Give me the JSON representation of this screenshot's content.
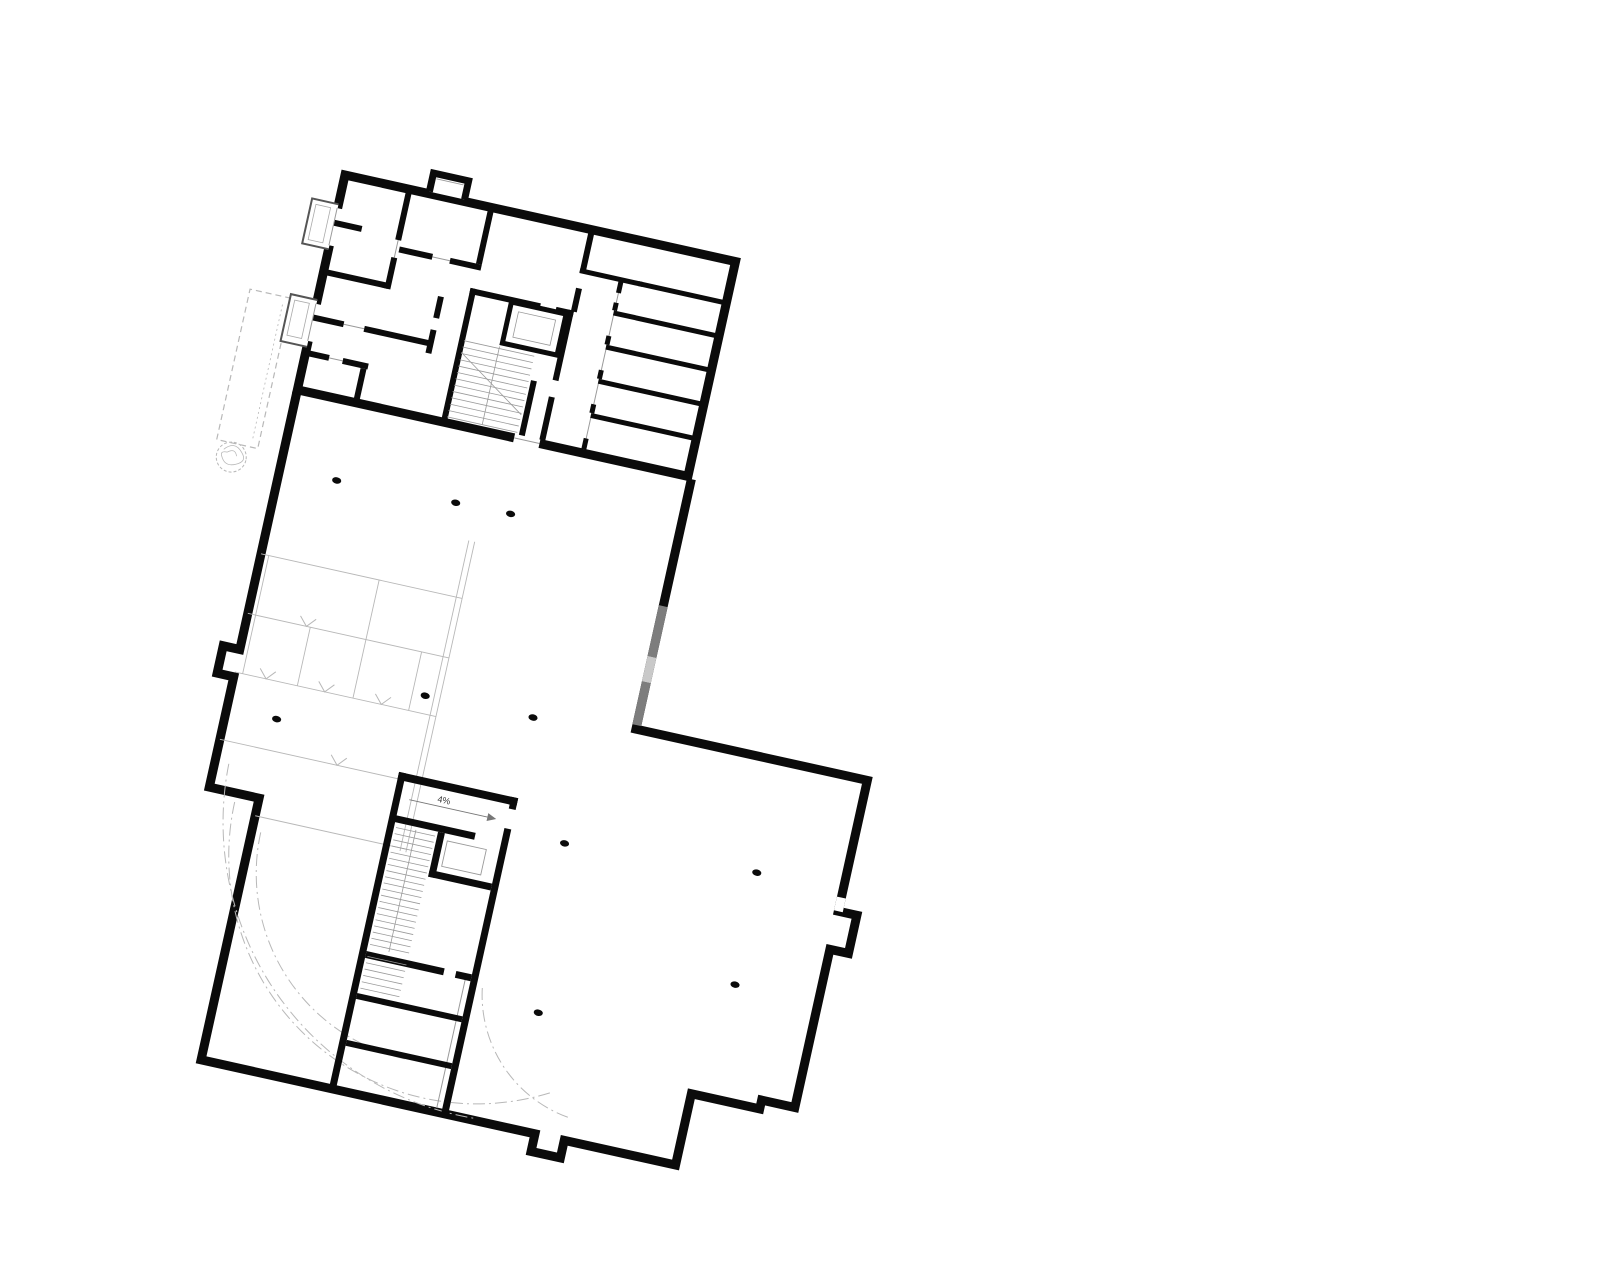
{
  "document": {
    "type": "architectural floor plan",
    "level": "basement / underground parking storey",
    "style": "poché black walls on white"
  },
  "labels": {
    "ramp_slope": "4%"
  },
  "palette": {
    "wall": "#0b0b0b",
    "thin": "#9a9a9a",
    "light": "#b8b8b8",
    "gray_dark": "#7d7d7d",
    "gray_light": "#c9c9c9",
    "bg": "#ffffff"
  },
  "canvas": {
    "width": 1600,
    "height": 1268
  },
  "transform": {
    "rotation_deg": 12.5,
    "pivot_x": 345,
    "pivot_y": 175
  },
  "plan": {
    "elements": [
      {
        "el": "path",
        "name": "canopy-outline",
        "stroke": "light",
        "sw": 1.2,
        "dash": "6 4",
        "fill": "none",
        "d": "M -26,132 L -68,132 L -68,286 L -26,286 Z"
      },
      {
        "el": "path",
        "name": "canopy-center-line",
        "stroke": "light",
        "sw": 0.8,
        "dash": "2 3",
        "fill": "none",
        "d": "M -33,140 L -33,280"
      },
      {
        "el": "circle",
        "name": "tree-symbol",
        "cx": -50,
        "cy": 300,
        "r": 15,
        "stroke": "light",
        "sw": 1,
        "dash": "3 2",
        "fill": "none"
      },
      {
        "el": "path",
        "name": "tree-crown-scribble",
        "stroke": "light",
        "sw": 0.8,
        "fill": "none",
        "d": "M -59,294 Q -50,283 -41,293 Q -33,301 -44,306 Q -54,311 -59,302 Q -63,296 -55,296 Q -48,290 -45,298"
      },
      {
        "el": "path",
        "name": "garage-outline",
        "fill": "#ffffff",
        "stroke": "wall",
        "sw": 9,
        "d": "M 0,222 L 0,486 L -17,486 L -17,514 L 0,514 L 0,627 L 51,627 L 51,895 L 393,895 L 393,913 L 423,913 L 423,895 L 537,895 L 537,822 L 607,822 L 607,813 L 641,813 L 641,651 L 660,651 L 660,612 L 641,612 L 641,478 L 404,478 L 404,222"
      },
      {
        "el": "rects",
        "name": "retaining-wall-gray",
        "fill": "gray_dark",
        "items": [
          [
            399.5,
            352,
            9,
            52
          ],
          [
            399.5,
            430,
            9,
            44
          ]
        ]
      },
      {
        "el": "rects",
        "name": "retaining-wall-lightgray",
        "fill": "gray_light",
        "items": [
          [
            399.5,
            404,
            9,
            26
          ]
        ]
      },
      {
        "el": "rects",
        "name": "garage-door-gap",
        "fill": "#ffffff",
        "items": [
          [
            636.5,
            598,
            9,
            14
          ]
        ]
      },
      {
        "el": "lines2",
        "name": "parking-stall-lines",
        "stroke": "light",
        "sw": 0.9,
        "items": [
          [
            0,
            388,
            206,
            388
          ],
          [
            0,
            449,
            206,
            449
          ],
          [
            0,
            509,
            206,
            509
          ],
          [
            0,
            578,
            206,
            578
          ],
          [
            51,
            645,
            206,
            645
          ],
          [
            8,
            388,
            8,
            509
          ],
          [
            64,
            449,
            64,
            509
          ],
          [
            121,
            388,
            121,
            509
          ],
          [
            178,
            449,
            178,
            509
          ],
          [
            200,
            330,
            200,
            648
          ],
          [
            206,
            330,
            206,
            648
          ]
        ]
      },
      {
        "el": "chevrons",
        "name": "parking-direction-chevron",
        "stroke": "light",
        "sw": 1,
        "points": [
          [
            32,
            509
          ],
          [
            92,
            509
          ],
          [
            150,
            509
          ],
          [
            120,
            578
          ],
          [
            60,
            449
          ]
        ]
      },
      {
        "el": "paths",
        "name": "ramp-dashdot-arc",
        "stroke": "light",
        "sw": 1,
        "dash": "12 4 2 4",
        "fill": "none",
        "items": [
          "M 28,636 A 248 248 0 0 0 400,851",
          "M 14,600 A 300 300 0 0 0 330,893",
          "M 60,660 A 190 190 0 0 0 250,850",
          "M 310,764 A 130 130 0 0 0 424,872"
        ]
      },
      {
        "el": "columns",
        "name": "column",
        "fill": "wall",
        "rx": 4.6,
        "ry": 3.2,
        "points": [
          [
            58,
            300
          ],
          [
            179,
            296
          ],
          [
            235,
            295
          ],
          [
            51,
            546
          ],
          [
            191,
            491
          ],
          [
            301,
            489
          ],
          [
            359,
            605
          ],
          [
            553,
            592
          ],
          [
            556,
            706
          ],
          [
            370,
            776
          ]
        ]
      },
      {
        "el": "lines2",
        "name": "core-door-line",
        "stroke": "thin",
        "sw": 1,
        "items": [
          [
            291.5,
            757,
            291.5,
            891
          ]
        ]
      },
      {
        "el": "rects",
        "name": "garage-core-walls",
        "fill": "wall",
        "items": [
          [
            182,
            571,
            122,
            8
          ],
          [
            182,
            571,
            7,
            324
          ],
          [
            297,
            571,
            7,
            12
          ],
          [
            297,
            603,
            7,
            292
          ],
          [
            186,
            614,
            84,
            7
          ],
          [
            233,
            621,
            7,
            46
          ],
          [
            233,
            660,
            64,
            7
          ],
          [
            189,
            753,
            80,
            7
          ],
          [
            281,
            753,
            16,
            7
          ],
          [
            189,
            796,
            108,
            6
          ],
          [
            189,
            844,
            108,
            6
          ]
        ]
      },
      {
        "el": "rect",
        "name": "garage-elevator-car",
        "x": 244,
        "y": 628,
        "w": 40,
        "h": 26,
        "stroke": "thin",
        "sw": 0.9,
        "fill": "none"
      },
      {
        "el": "lines",
        "name": "garage-stair-treads",
        "x1": 191,
        "x2": 231,
        "y": 626,
        "dy": 6.3,
        "n": 20,
        "stroke": "thin",
        "sw": 0.8
      },
      {
        "el": "lines",
        "name": "garage-stair-treads-lower",
        "x1": 191,
        "x2": 231,
        "y": 758,
        "dy": 6.5,
        "n": 6,
        "stroke": "thin",
        "sw": 0.8
      },
      {
        "el": "lines2",
        "name": "garage-stair-centerline",
        "stroke": "thin",
        "sw": 0.8,
        "items": [
          [
            211,
            624,
            211,
            749
          ]
        ]
      },
      {
        "el": "lines2",
        "name": "ramp-arrow-line",
        "stroke": "#777777",
        "sw": 0.9,
        "items": [
          [
            198,
            596,
            278,
            596
          ]
        ]
      },
      {
        "el": "path",
        "name": "ramp-arrow-head",
        "fill": "#777777",
        "stroke": "none",
        "d": "M 278,592 L 287,596 L 278,600 Z"
      },
      {
        "el": "text",
        "name": "ramp-slope-label",
        "bind": "labels.ramp_slope",
        "x": 232,
        "y": 592,
        "size": 9,
        "fill": "#333333",
        "anchor": "middle"
      },
      {
        "el": "rect",
        "name": "wing-outline",
        "x": 0,
        "y": 0,
        "w": 400,
        "h": 220,
        "fill": "#ffffff",
        "stroke": "wall",
        "sw": 9
      },
      {
        "el": "rects",
        "name": "wing-bottom-door-gap",
        "fill": "#ffffff",
        "items": [
          [
            222,
            213.5,
            26,
            13
          ]
        ]
      },
      {
        "el": "lines2",
        "name": "wing-bottom-door-line",
        "stroke": "thin",
        "sw": 1,
        "items": [
          [
            222,
            220,
            248,
            220
          ]
        ]
      },
      {
        "el": "path",
        "name": "roof-shaft-bump",
        "fill": "#ffffff",
        "stroke": "wall",
        "sw": 7,
        "d": "M 86,-2 L 86,-21 L 122,-21 L 122,-2"
      },
      {
        "el": "lines2",
        "name": "shaft-window-line",
        "stroke": "thin",
        "sw": 0.9,
        "items": [
          [
            90,
            -16,
            118,
            -16
          ]
        ]
      },
      {
        "el": "path",
        "name": "balcony-box-upper",
        "fill": "#ffffff",
        "stroke": "#555555",
        "sw": 2,
        "d": "M 0,30 L -27,30 L -27,76 L 0,76"
      },
      {
        "el": "rects",
        "name": "balcony-upper-wall-gap",
        "fill": "#ffffff",
        "items": [
          [
            -5,
            34,
            10,
            38
          ]
        ]
      },
      {
        "el": "rect",
        "name": "balcony-upper-inner",
        "x": -22,
        "y": 35,
        "w": 15,
        "h": 36,
        "stroke": "#aaaaaa",
        "sw": 0.8,
        "fill": "none"
      },
      {
        "el": "path",
        "name": "balcony-box-lower",
        "fill": "#ffffff",
        "stroke": "#555555",
        "sw": 2,
        "d": "M 0,128 L -27,128 L -27,176 L 0,176"
      },
      {
        "el": "rects",
        "name": "balcony-lower-wall-gap",
        "fill": "#ffffff",
        "items": [
          [
            -5,
            132,
            10,
            38
          ]
        ]
      },
      {
        "el": "rect",
        "name": "balcony-lower-inner",
        "x": -22,
        "y": 133,
        "w": 15,
        "h": 36,
        "stroke": "#aaaaaa",
        "sw": 0.8,
        "fill": "none"
      },
      {
        "el": "lines2",
        "name": "wing-door-lines",
        "stroke": "thin",
        "sw": 1,
        "items": [
          [
            292.5,
            44,
            292.5,
            216
          ],
          [
            31,
            146,
            52,
            146
          ],
          [
            103,
            61,
            121,
            61
          ],
          [
            219,
            86,
            235,
            86
          ],
          [
            24,
            182,
            38,
            182
          ],
          [
            66,
            52,
            66,
            70
          ],
          [
            -0.5,
            34,
            -0.5,
            72
          ],
          [
            -0.5,
            132,
            -0.5,
            170
          ]
        ]
      },
      {
        "el": "rects",
        "name": "wing-interior-walls",
        "fill": "wall",
        "items": [
          [
            63,
            0,
            6,
            52
          ],
          [
            63,
            70,
            6,
            32
          ],
          [
            0,
            96,
            66,
            6
          ],
          [
            0,
            46,
            28,
            6
          ],
          [
            0,
            143,
            31,
            6
          ],
          [
            52,
            143,
            68,
            6
          ],
          [
            117,
            98,
            6,
            22
          ],
          [
            117,
            132,
            6,
            24
          ],
          [
            0,
            179,
            24,
            6
          ],
          [
            38,
            179,
            26,
            6
          ],
          [
            57,
            185,
            6,
            35
          ],
          [
            147,
            0,
            6,
            58
          ],
          [
            69,
            58,
            34,
            6
          ],
          [
            121,
            58,
            32,
            6
          ],
          [
            147,
            83,
            72,
            6
          ],
          [
            235,
            83,
            18,
            6
          ],
          [
            147,
            83,
            6,
            133
          ],
          [
            247,
            83,
            6,
            72
          ],
          [
            247,
            172,
            6,
            44
          ],
          [
            226,
            160,
            6,
            56
          ],
          [
            250,
            0,
            6,
            44
          ],
          [
            250,
            60,
            6,
            24
          ],
          [
            250,
            40,
            64,
            5
          ],
          [
            310,
            40,
            86,
            5
          ],
          [
            292,
            74,
            104,
            5
          ],
          [
            292,
            109,
            104,
            5
          ],
          [
            292,
            144,
            104,
            5
          ],
          [
            292,
            179,
            104,
            5
          ],
          [
            290,
            44,
            5,
            12
          ],
          [
            290,
            66,
            5,
            8
          ],
          [
            290,
            100,
            5,
            9
          ],
          [
            290,
            135,
            5,
            9
          ],
          [
            290,
            170,
            5,
            9
          ],
          [
            290,
            205,
            5,
            11
          ]
        ]
      },
      {
        "el": "rect",
        "name": "wing-elevator-shaft",
        "x": 190,
        "y": 88,
        "w": 56,
        "h": 42,
        "fill": "#ffffff",
        "stroke": "wall",
        "sw": 5
      },
      {
        "el": "rect",
        "name": "wing-elevator-car",
        "x": 199,
        "y": 96,
        "w": 38,
        "h": 26,
        "stroke": "thin",
        "sw": 0.8,
        "fill": "none"
      },
      {
        "el": "lines",
        "name": "wing-stair-treads",
        "x1": 152,
        "x2": 224,
        "y": 136,
        "dy": 6.5,
        "n": 13,
        "stroke": "thin",
        "sw": 0.8
      },
      {
        "el": "lines2",
        "name": "wing-stair-centerline",
        "stroke": "thin",
        "sw": 0.8,
        "items": [
          [
            188,
            134,
            188,
            214
          ],
          [
            152,
            148,
            224,
            196
          ]
        ]
      }
    ]
  }
}
